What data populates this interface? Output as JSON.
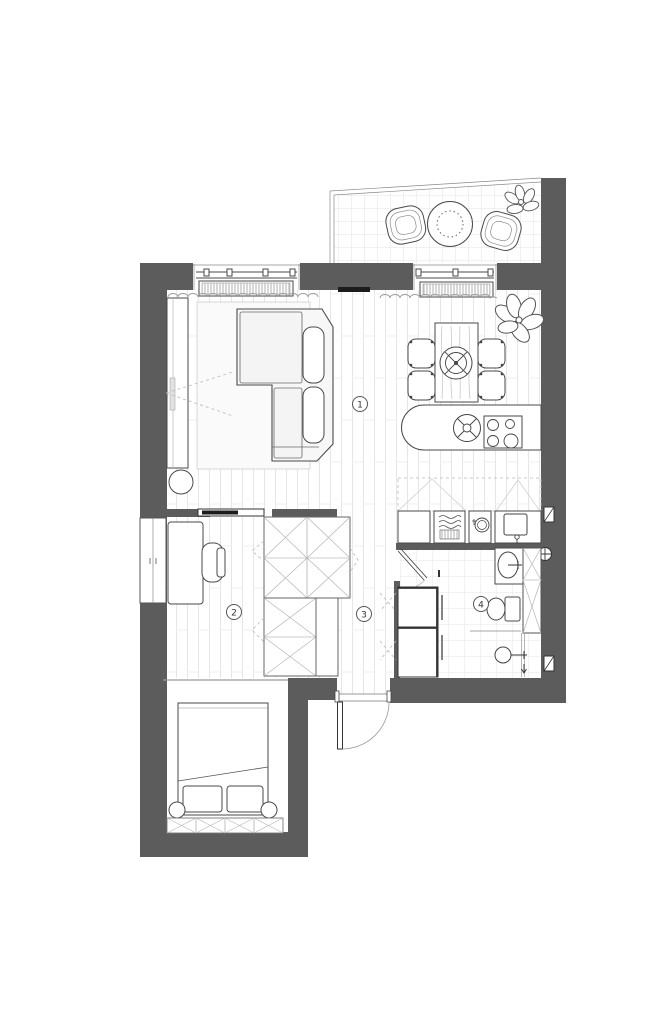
{
  "plan": {
    "type": "apartment-floor-plan",
    "room_labels": [
      {
        "number": "1",
        "name": "living-room-kitchen"
      },
      {
        "number": "2",
        "name": "bedroom-study"
      },
      {
        "number": "3",
        "name": "hallway"
      },
      {
        "number": "4",
        "name": "bathroom"
      }
    ],
    "fixtures": [
      "balcony-chair",
      "balcony-table",
      "plant",
      "sofa",
      "rug",
      "media-console",
      "floor-lamp",
      "wall-tv",
      "radiator",
      "window",
      "curtain",
      "dining-table",
      "dining-chair",
      "pendant-lamp",
      "kitchen-island",
      "island-sink",
      "cooktop",
      "washing-machine",
      "dishwasher",
      "kitchen-sink",
      "wardrobe",
      "sliding-door",
      "desk",
      "desk-chair",
      "built-in-closet",
      "washbasin",
      "toilet",
      "shower",
      "tall-cabinet",
      "appliance-stack",
      "bed",
      "pillow",
      "storage-bench",
      "entry-door"
    ],
    "colors": {
      "wall": "#5c5c5c",
      "outline": "#4a4a4a",
      "floor_line": "#e5e5e5",
      "tile_line": "#e3e3e3",
      "rug": "#f7f7f7",
      "tv": "#1c1c1c",
      "paper": "#ffffff"
    }
  }
}
